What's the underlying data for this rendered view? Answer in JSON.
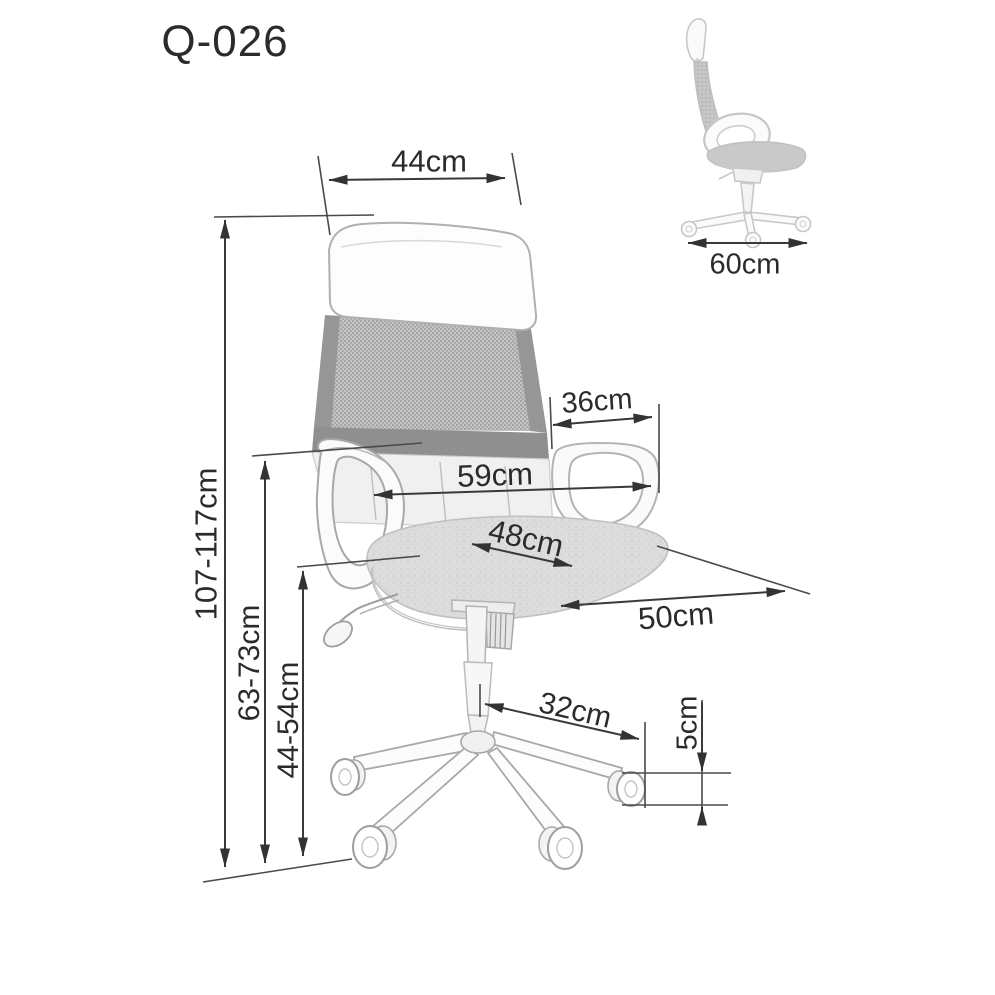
{
  "title": "Q-026",
  "colors": {
    "dimension_line": "#3a3a3a",
    "label_text": "#2b2b2b",
    "chair_outline": "#ababab",
    "mesh_fill": "#c2c2c2",
    "background": "#ffffff"
  },
  "dimensions": {
    "headrest_width": "44cm",
    "side_depth": "60cm",
    "backrest_lower_width": "36cm",
    "overall_width": "59cm",
    "seat_width": "48cm",
    "seat_depth": "50cm",
    "base_radius": "32cm",
    "caster_height": "5cm",
    "total_height": "107-117cm",
    "backrest_height": "63-73cm",
    "seat_height": "44-54cm"
  }
}
